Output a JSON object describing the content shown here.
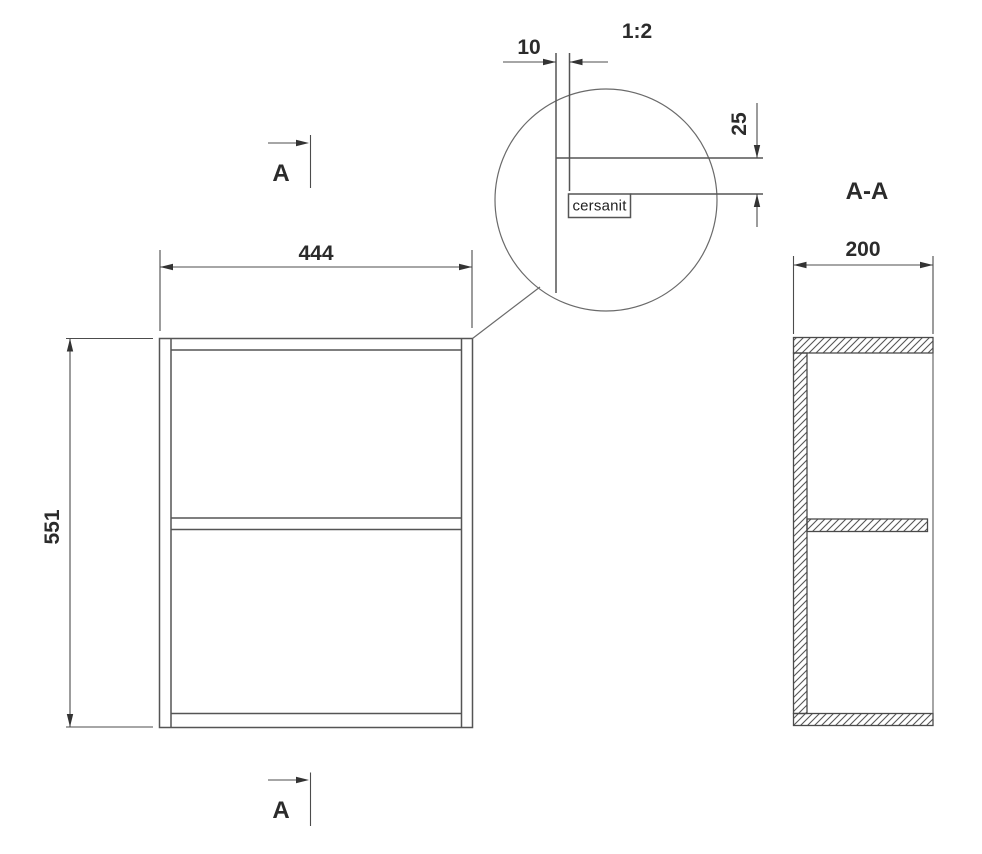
{
  "brand_logo": "cersanit",
  "front_view": {
    "width": "444",
    "height": "551"
  },
  "section_view": {
    "title": "A-A",
    "depth": "200"
  },
  "detail_view": {
    "scale": "1:2",
    "edge_offset": "10",
    "logo_offset": "25"
  },
  "section_markers": {
    "top": "A",
    "bottom": "A"
  },
  "colors": {
    "line": "#555555",
    "text": "#2b2b2b",
    "background": "#ffffff"
  }
}
